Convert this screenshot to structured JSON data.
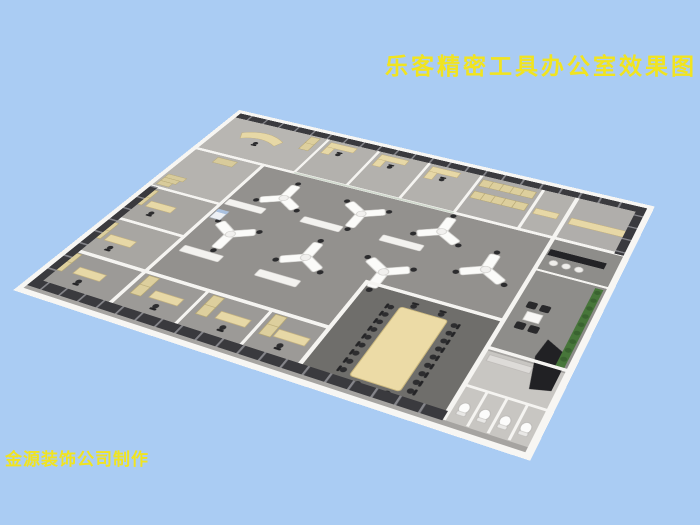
{
  "texts": {
    "title": "乐客精密工具办公室效果图",
    "credit": "金源装饰公司制作"
  },
  "colors": {
    "background": "#aaccf3",
    "text_yellow": "#f1e41f",
    "wall_white": "#f5f4f1",
    "floor_open_office": "#93918e",
    "floor_conference": "#6f6e6b",
    "floor_toilets": "#c8c6c2",
    "furniture_beige": "#e7d8a6",
    "window_dark": "#3a3a3e",
    "chair_black": "#2c2c2e",
    "desk_white": "#fbfbf9",
    "plant_green": "#47763a",
    "glass_partition": "#c9d3c7"
  },
  "scene": {
    "type": "3d-isometric-office-floorplan-render",
    "open_office_desk_clusters": 7,
    "seats_per_cluster": 3,
    "conference_room_chairs": 22,
    "north_private_offices": 3,
    "south_glass_offices": 4,
    "west_offices": 2,
    "cafe_stools": 3,
    "lounge_armchairs": 4,
    "toilet_stalls": 4,
    "features": [
      "executive-office-curved-desk",
      "locker-room",
      "copier",
      "cafe-counter",
      "lounge-coffee-table",
      "vertical-plant-wall",
      "reception-black-desk",
      "conference-long-table",
      "perimeter-dark-windows"
    ]
  }
}
